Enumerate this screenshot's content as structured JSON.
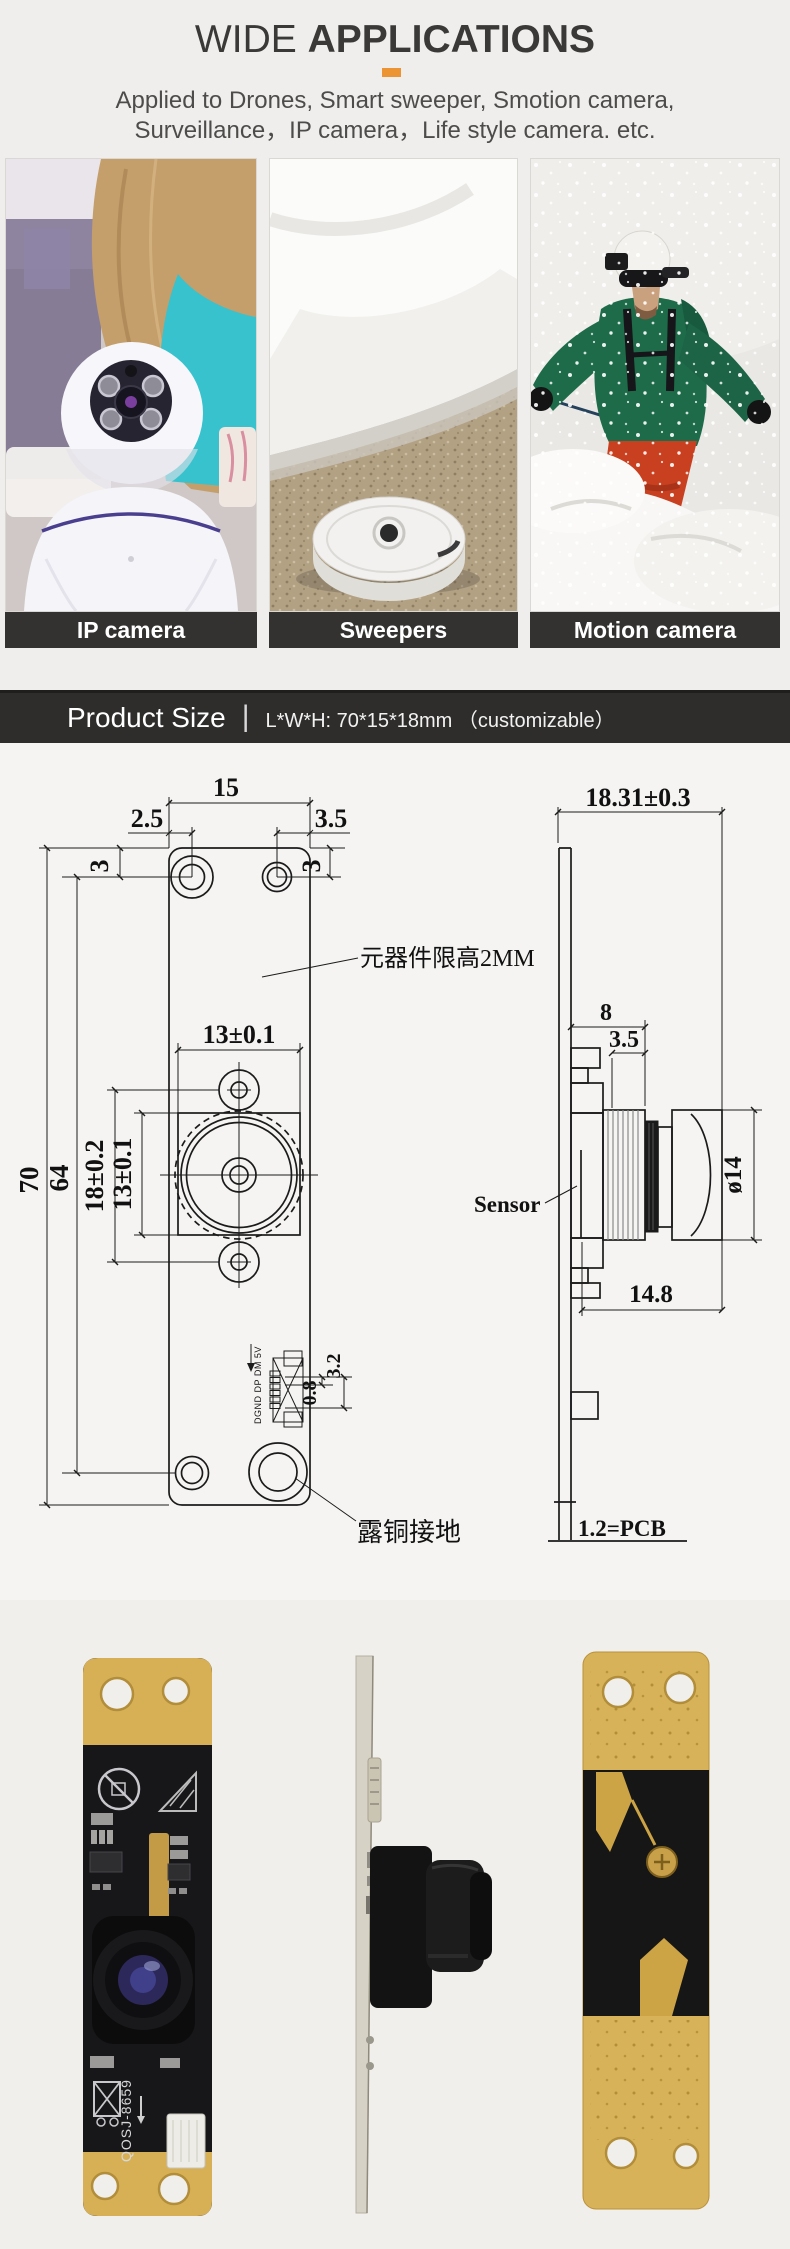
{
  "header": {
    "title_light": "WIDE",
    "title_bold": "APPLICATIONS",
    "accent_color": "#ec9334",
    "subtitle_line1": "Applied to Drones, Smart sweeper, Smotion camera,",
    "subtitle_line2": "Surveillance，IP camera，Life style camera. etc."
  },
  "applications": {
    "cards": [
      {
        "label": "IP camera"
      },
      {
        "label": "Sweepers"
      },
      {
        "label": "Motion camera"
      }
    ]
  },
  "section_bar": {
    "title": "Product Size",
    "separator": "|",
    "spec": "L*W*H: 70*15*18mm （customizable）"
  },
  "front_view": {
    "dim_width": "15",
    "dim_hole_left": "2.5",
    "dim_hole_right": "3.5",
    "dim_hole_top_left": "3",
    "dim_hole_top_right": "3",
    "dim_height": "70",
    "dim_hole_span": "64",
    "dim_lens_width": "13±0.1",
    "dim_hole_pitch": "18±0.2",
    "dim_lens_height": "13±0.1",
    "dim_pad_pitch": "0.8",
    "dim_pad_span": "3.2",
    "connector_pins": "DGND DP DM 5V",
    "note_height_limit": "元器件限高2MM",
    "note_ground": "露铜接地"
  },
  "side_view": {
    "dim_total_height": "18.31±0.3",
    "dim_holder": "8",
    "dim_sensor": "3.5",
    "dim_lens_dia": "ø14",
    "dim_lens_len": "14.8",
    "label_sensor": "Sensor",
    "label_pcb": "1.2=PCB"
  },
  "photos": {
    "front_silkscreen": "QOSJ-8659"
  }
}
